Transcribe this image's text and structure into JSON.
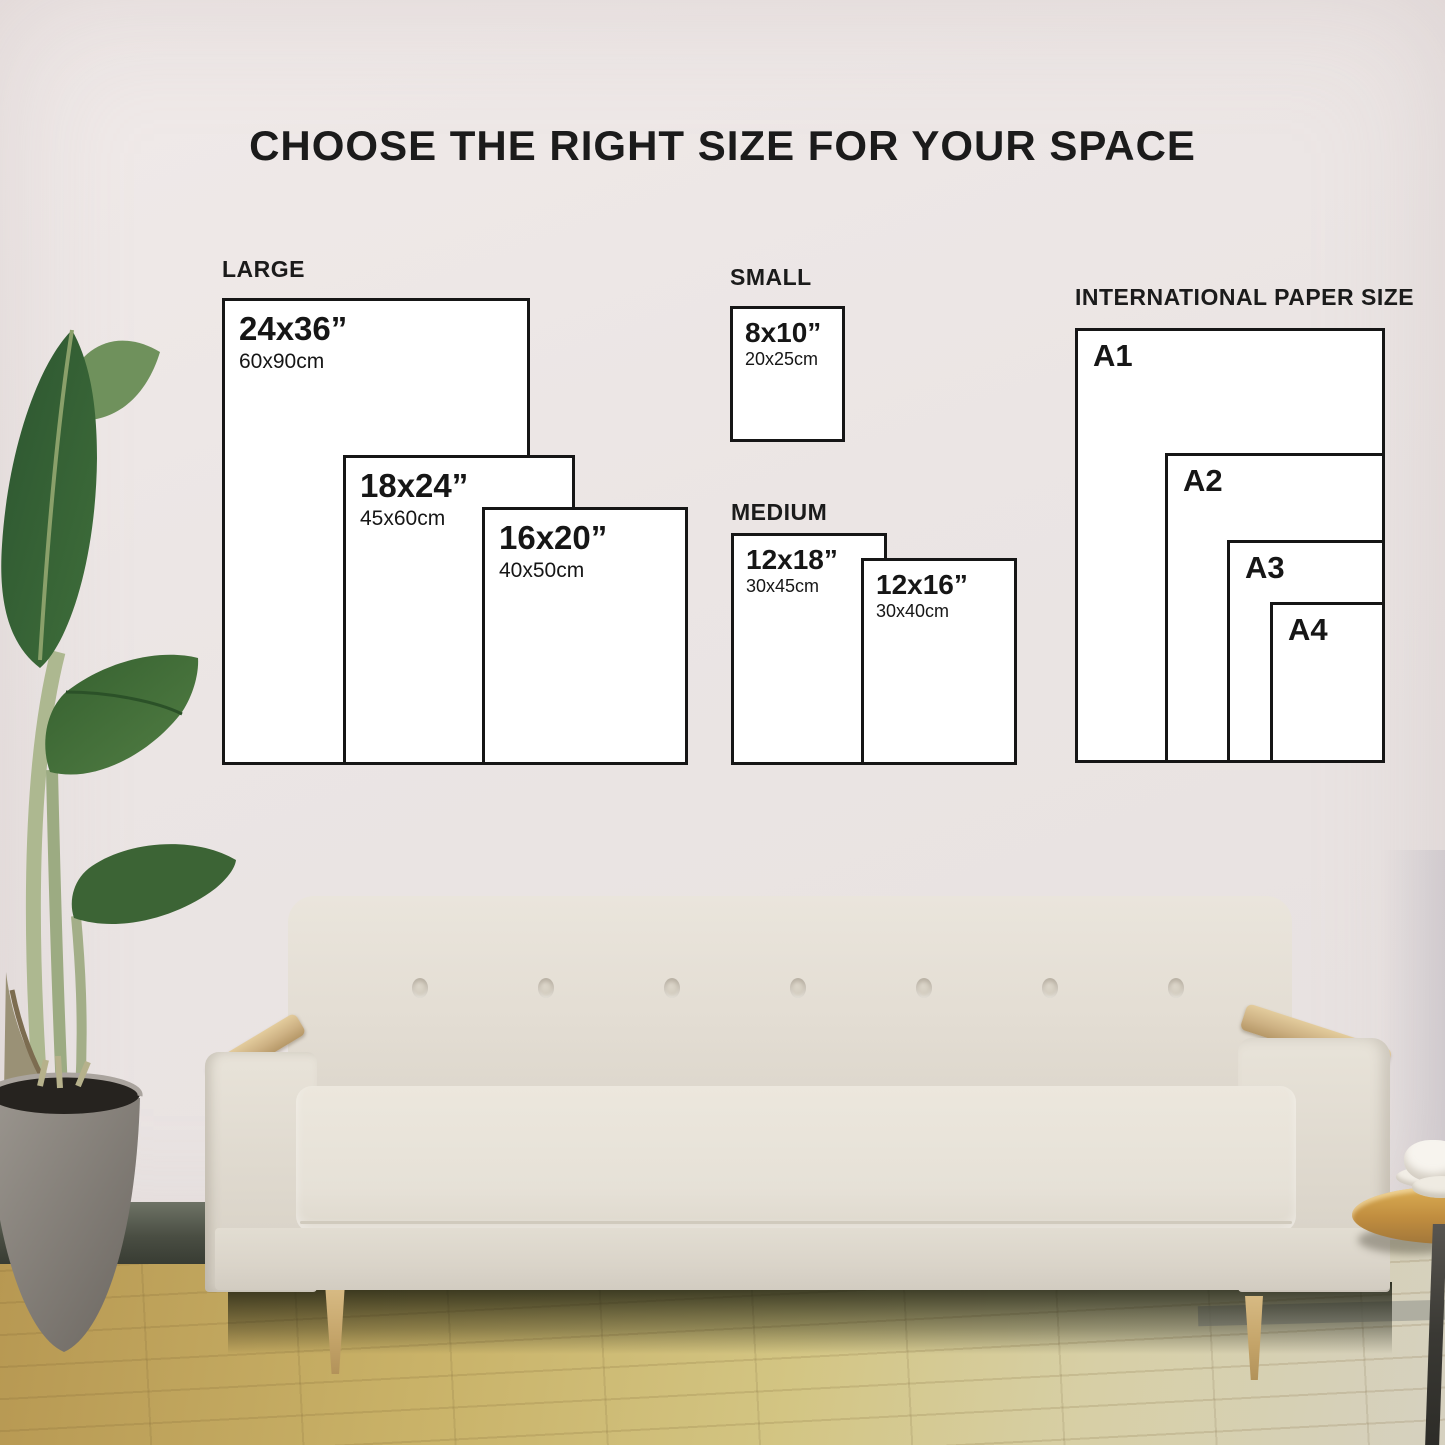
{
  "title": "CHOOSE THE RIGHT SIZE FOR YOUR SPACE",
  "groups": {
    "large": {
      "label": "LARGE",
      "sizes": [
        {
          "inches": "24x36”",
          "cm": "60x90cm"
        },
        {
          "inches": "18x24”",
          "cm": "45x60cm"
        },
        {
          "inches": "16x20”",
          "cm": "40x50cm"
        }
      ]
    },
    "small": {
      "label": "SMALL",
      "sizes": [
        {
          "inches": "8x10”",
          "cm": "20x25cm"
        }
      ]
    },
    "medium": {
      "label": "MEDIUM",
      "sizes": [
        {
          "inches": "12x18”",
          "cm": "30x45cm"
        },
        {
          "inches": "12x16”",
          "cm": "30x40cm"
        }
      ]
    },
    "international": {
      "label": "INTERNATIONAL PAPER SIZE",
      "sizes": [
        {
          "name": "A1"
        },
        {
          "name": "A2"
        },
        {
          "name": "A3"
        },
        {
          "name": "A4"
        }
      ]
    }
  },
  "colors": {
    "box_fill": "#ffffff",
    "box_border": "#161616",
    "text": "#1b1b1b",
    "wall": "#ebe5e4",
    "floor_wood": "#cdb573",
    "sofa_fabric": "#e6e1d7",
    "plant_green": "#35602f"
  }
}
